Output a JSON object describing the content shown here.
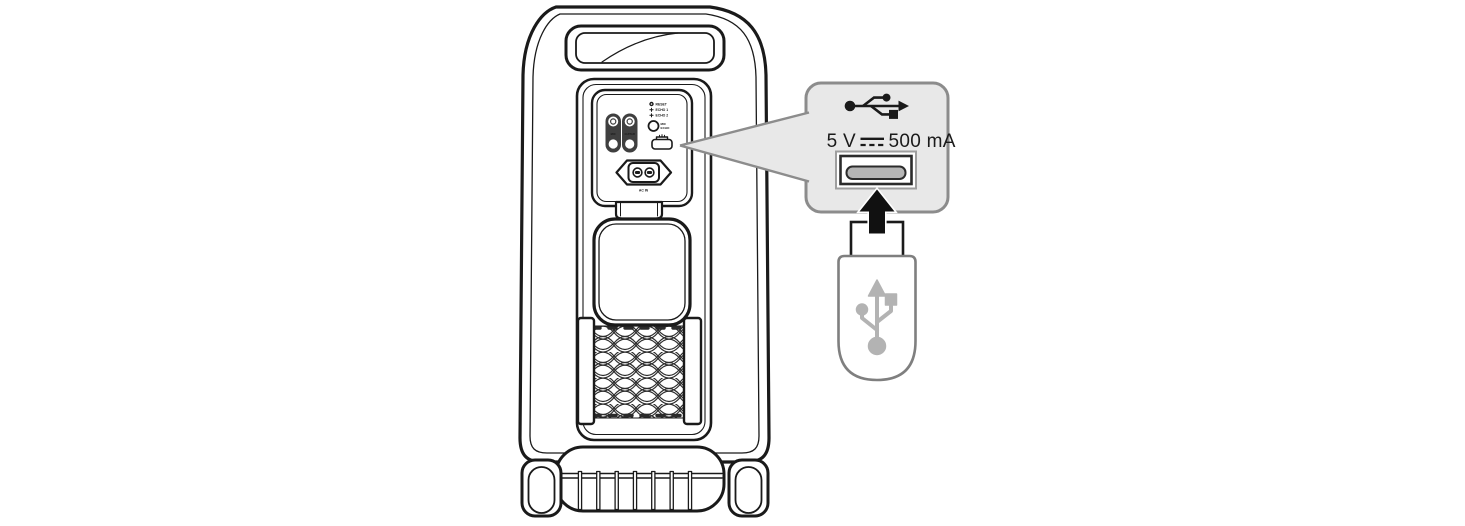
{
  "figure": {
    "description_name": "speaker-rear-usb-connection-illustration"
  },
  "panel": {
    "reset_label": "RESET",
    "echo1_label": "ECHO 1",
    "echo2_label": "ECHO 2",
    "knob_label_line1": "MIC",
    "knob_label_line2": "ECHO",
    "mic_jack_label": "MIC",
    "guitar_jack_label": "GUITAR",
    "ac_in_label": "AC IN"
  },
  "callout": {
    "voltage": "5 V",
    "current": "500 mA",
    "separator_icon": "dc-symbol",
    "port_icon": "usb-port",
    "header_icon": "usb-trident"
  },
  "icons": {
    "usb_trident": "usb-trident-icon",
    "insert_arrow": "arrow-up-icon",
    "usb_drive_symbol": "usb-trident-icon-gray",
    "gear": "gear-icon",
    "plus": "plus-icon",
    "usb_port_small": "usb-port-icon",
    "power_inlet": "ac-power-inlet-icon"
  },
  "colors": {
    "line": "#1a1a1a",
    "callout_fill": "#e8e8e8",
    "callout_border": "#8c8c8c",
    "jack_plate": "#3f3f3f",
    "slot_fill": "#b5b5b5",
    "drive_outline": "#7f7f7f",
    "drive_symbol": "#b3b3b3"
  }
}
